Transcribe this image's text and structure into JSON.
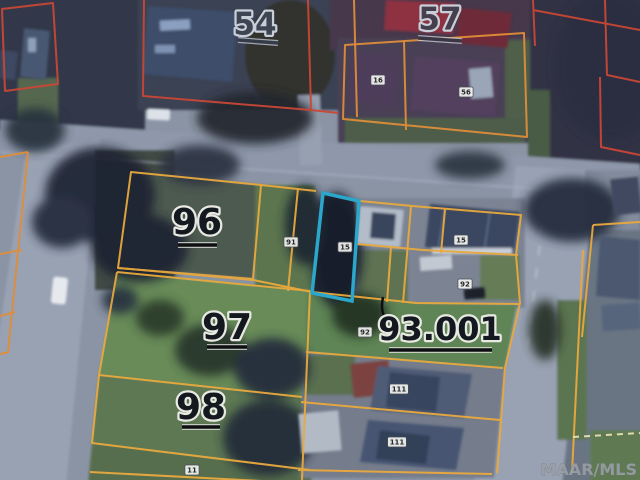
{
  "map": {
    "watermark": "MAAR/MLS",
    "highlight": {
      "color": "#2ba7cc",
      "chip": "15"
    },
    "line_colors": {
      "red": "#c94736",
      "orange": "#de8d3a",
      "yellow": "#e9a93e",
      "highlight": "#2ba7cc"
    },
    "big_labels": [
      {
        "text": "54",
        "x": 255,
        "y": 26,
        "size": 31,
        "color": "#3d4452",
        "halo": "#c9cfd8",
        "ul": [
          238,
          40,
          278,
          43
        ],
        "ul_color": "#343b49"
      },
      {
        "text": "57",
        "x": 440,
        "y": 21,
        "size": 31,
        "color": "#453f4e",
        "halo": "#c9cfd8",
        "ul": [
          418,
          38,
          462,
          41
        ],
        "ul_color": "#3a3644"
      },
      {
        "text": "96",
        "x": 197,
        "y": 224,
        "size": 36,
        "color": "#14181f",
        "halo": "#e8e9e3",
        "ul": [
          178,
          245,
          217,
          245
        ],
        "ul_color": "#0d0f13"
      },
      {
        "text": "97",
        "x": 227,
        "y": 329,
        "size": 36,
        "color": "#14181f",
        "halo": "#e8e9e3",
        "ul": [
          207,
          347,
          247,
          347
        ],
        "ul_color": "#0d0f13"
      },
      {
        "text": "98",
        "x": 201,
        "y": 409,
        "size": 36,
        "color": "#14181f",
        "halo": "#e8e9e3",
        "ul": [
          182,
          427,
          220,
          427
        ],
        "ul_color": "#0d0f13"
      },
      {
        "text": "93.001",
        "x": 440,
        "y": 331,
        "size": 32,
        "color": "#14181f",
        "halo": "#e8e9e3",
        "ul": [
          389,
          350,
          492,
          350
        ],
        "ul_color": "#0d0f13"
      }
    ],
    "address_chips": [
      {
        "text": "16",
        "x": 378,
        "y": 80
      },
      {
        "text": "56",
        "x": 466,
        "y": 92
      },
      {
        "text": "91",
        "x": 291,
        "y": 242
      },
      {
        "text": "15",
        "x": 345,
        "y": 247
      },
      {
        "text": "15",
        "x": 461,
        "y": 240
      },
      {
        "text": "92",
        "x": 465,
        "y": 284
      },
      {
        "text": "92",
        "x": 365,
        "y": 332
      },
      {
        "text": "111",
        "x": 399,
        "y": 389
      },
      {
        "text": "111",
        "x": 397,
        "y": 442
      },
      {
        "text": "11",
        "x": 192,
        "y": 470
      }
    ]
  }
}
